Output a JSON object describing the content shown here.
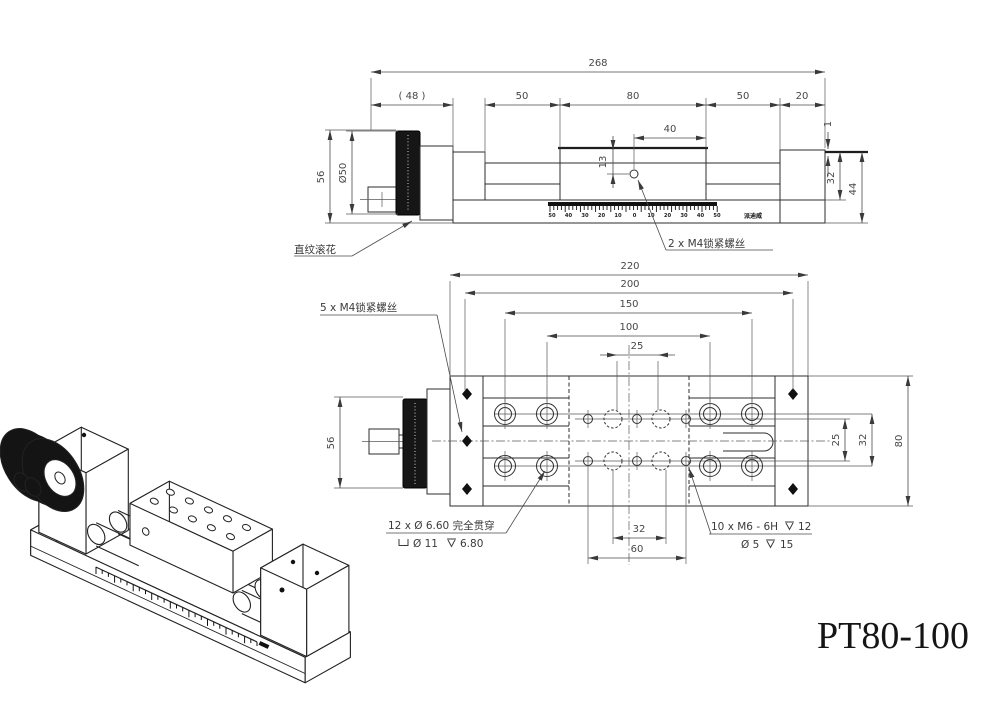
{
  "title": "PT80-100",
  "side_view": {
    "dim_268": "268",
    "dim_48": "( 48 )",
    "dim_50a": "50",
    "dim_80": "80",
    "dim_50b": "50",
    "dim_20": "20",
    "dim_40": "40",
    "dim_13": "13",
    "dim_56": "56",
    "dim_dia50": "Ø50",
    "dim_1": "1",
    "dim_32": "32",
    "dim_44": "44",
    "label_knurl": "直纹滚花",
    "label_lockscrew": "2 x M4锁紧螺丝",
    "ruler": [
      "50",
      "40",
      "30",
      "20",
      "10",
      "0",
      "10",
      "20",
      "30",
      "40",
      "50"
    ],
    "brand": "派迪威"
  },
  "plan_view": {
    "dim_220": "220",
    "dim_200": "200",
    "dim_150": "150",
    "dim_100": "100",
    "dim_25_top": "25",
    "dim_56": "56",
    "dim_32_bottom": "32",
    "dim_60": "60",
    "dim_25_right": "25",
    "dim_32_right": "32",
    "dim_80": "80",
    "label_lockscrew5": "5 x M4锁紧螺丝",
    "label_counterbore_1": "12 x Ø 6.60 完全贯穿",
    "label_counterbore_dia": "Ø 11",
    "label_counterbore_depth": "6.80",
    "label_tap_1": "10 x M6 - 6H",
    "label_tap_depth": "12",
    "label_tap_dia": "Ø 5",
    "label_tap_depth2": "15"
  }
}
